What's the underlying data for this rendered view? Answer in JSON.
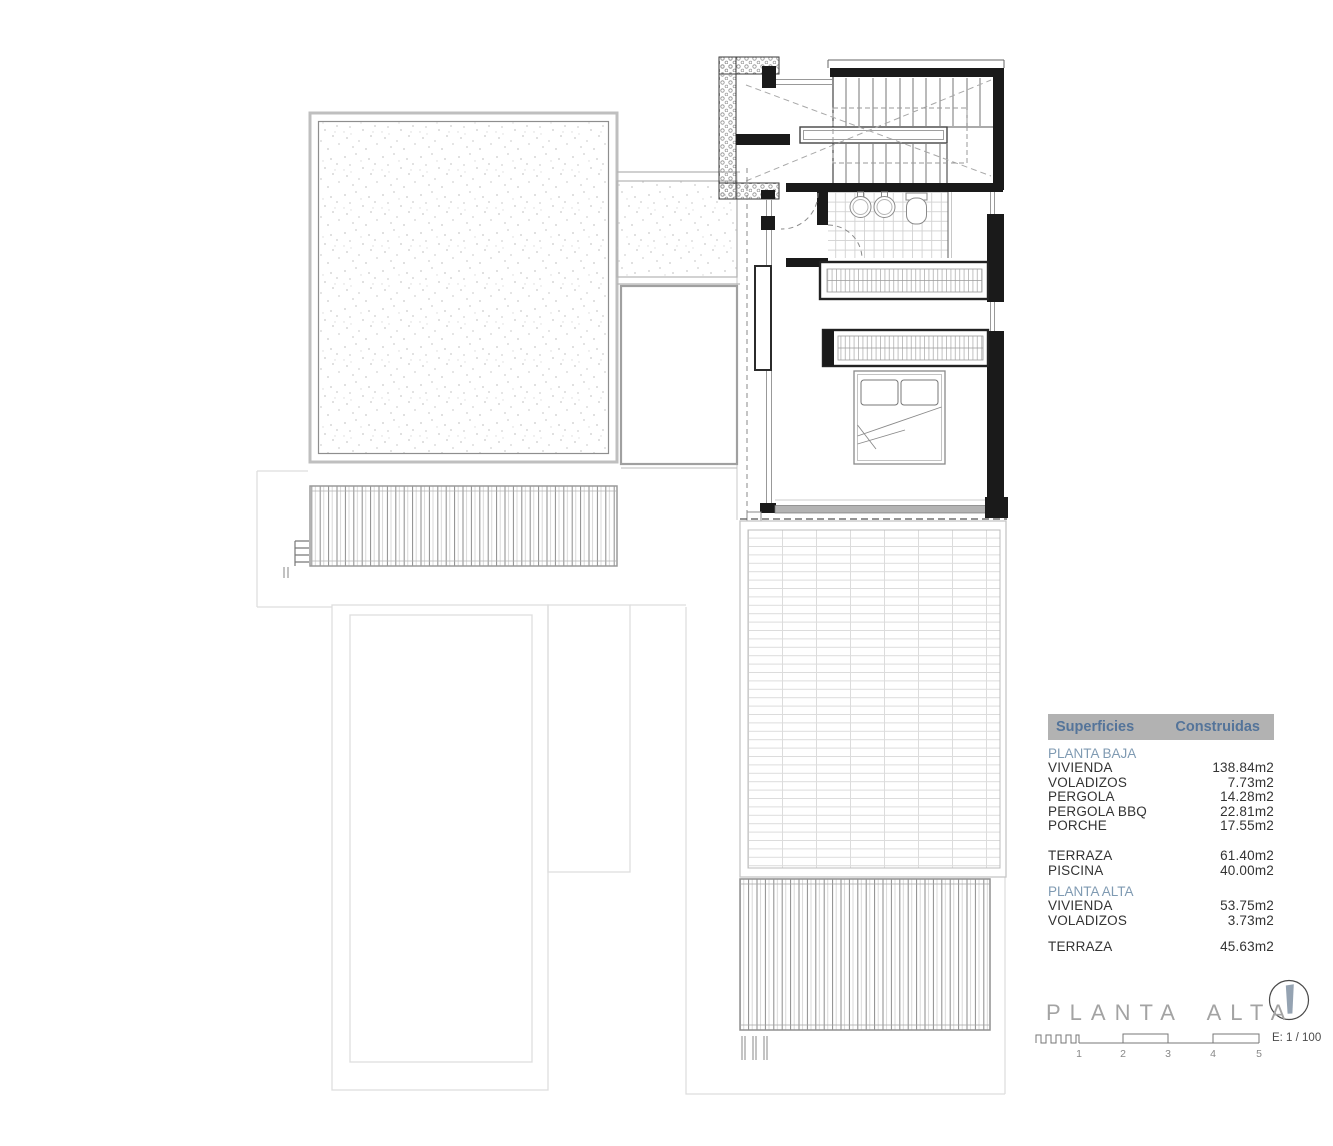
{
  "table": {
    "header": {
      "col1": "Superficies",
      "col2": "Construidas"
    },
    "sections": [
      {
        "title": "PLANTA BAJA",
        "rows": [
          {
            "label": "VIVIENDA",
            "value": "138.84m2"
          },
          {
            "label": "VOLADIZOS",
            "value": "7.73m2"
          },
          {
            "label": "PERGOLA",
            "value": "14.28m2"
          },
          {
            "label": "PERGOLA BBQ",
            "value": "22.81m2"
          },
          {
            "label": "PORCHE",
            "value": "17.55m2"
          }
        ]
      },
      {
        "title": "",
        "rows": [
          {
            "label": "TERRAZA",
            "value": "61.40m2"
          },
          {
            "label": "PISCINA",
            "value": "40.00m2"
          }
        ]
      },
      {
        "title": "PLANTA ALTA",
        "rows": [
          {
            "label": "VIVIENDA",
            "value": "53.75m2"
          },
          {
            "label": "VOLADIZOS",
            "value": "3.73m2"
          }
        ]
      },
      {
        "title": "",
        "rows": [
          {
            "label": "TERRAZA",
            "value": "45.63m2"
          }
        ]
      }
    ]
  },
  "titleblock": {
    "title": "PLANTA ALTA",
    "scale_text": "E: 1 / 100",
    "scale_labels": [
      "1",
      "2",
      "3",
      "4",
      "5"
    ],
    "north_icon": "north-arrow-compass"
  },
  "colors": {
    "header_bg": "#b2b2b2",
    "header_text": "#54749a",
    "section_text": "#7f9ab2",
    "body_text": "#333333",
    "title_gray": "#a3a3a3",
    "needle_blue": "#95a3b2",
    "wall_black": "#1a1a1a"
  }
}
